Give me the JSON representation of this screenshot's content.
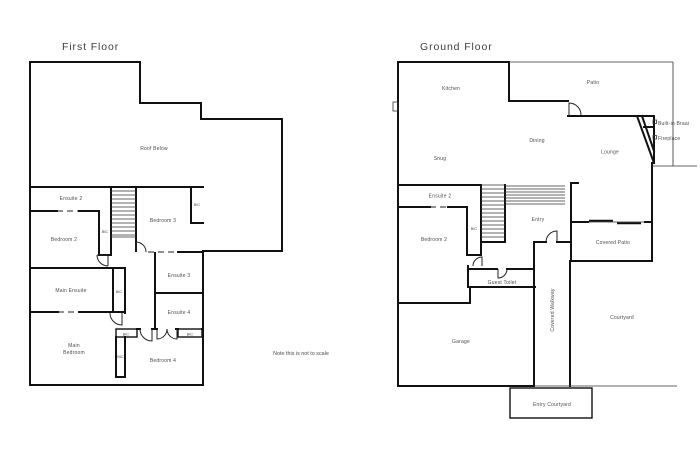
{
  "page": {
    "note": "Note this is not to scale",
    "colors": {
      "wall": "#111111",
      "label": "#4c4c4c",
      "title": "#3e3e3e",
      "background": "#ffffff"
    }
  },
  "first_floor": {
    "title": "First Floor",
    "labels": {
      "roof_below": "Roof Below",
      "ensuite2": "Ensuite 2",
      "bedroom2": "Bedroom 2",
      "bedroom3": "Bedroom 3",
      "ensuite3": "Ensuite 3",
      "ensuite4": "Ensuite 4",
      "main_ensuite": "Main Ensuite",
      "main_bedroom_line1": "Main",
      "main_bedroom_line2": "Bedroom",
      "bedroom4": "Bedroom 4",
      "bic": "BIC"
    }
  },
  "ground_floor": {
    "title": "Ground Floor",
    "labels": {
      "kitchen": "Kitchen",
      "patio": "Patio",
      "snug": "Snug",
      "dining": "Dining",
      "lounge": "Lounge",
      "built_in_braai": "Built-in Braai",
      "fireplace": "Fireplace",
      "ensuite2": "Ensuite 2",
      "bedroom2": "Bedroom 2",
      "bic": "BIC",
      "entry": "Entry",
      "guest_toilet": "Guest Toilet",
      "covered_patio": "Covered Patio",
      "covered_walkway": "Covered Walkway",
      "garage": "Garage",
      "courtyard": "Courtyard",
      "entry_courtyard": "Entry Courtyard"
    }
  }
}
